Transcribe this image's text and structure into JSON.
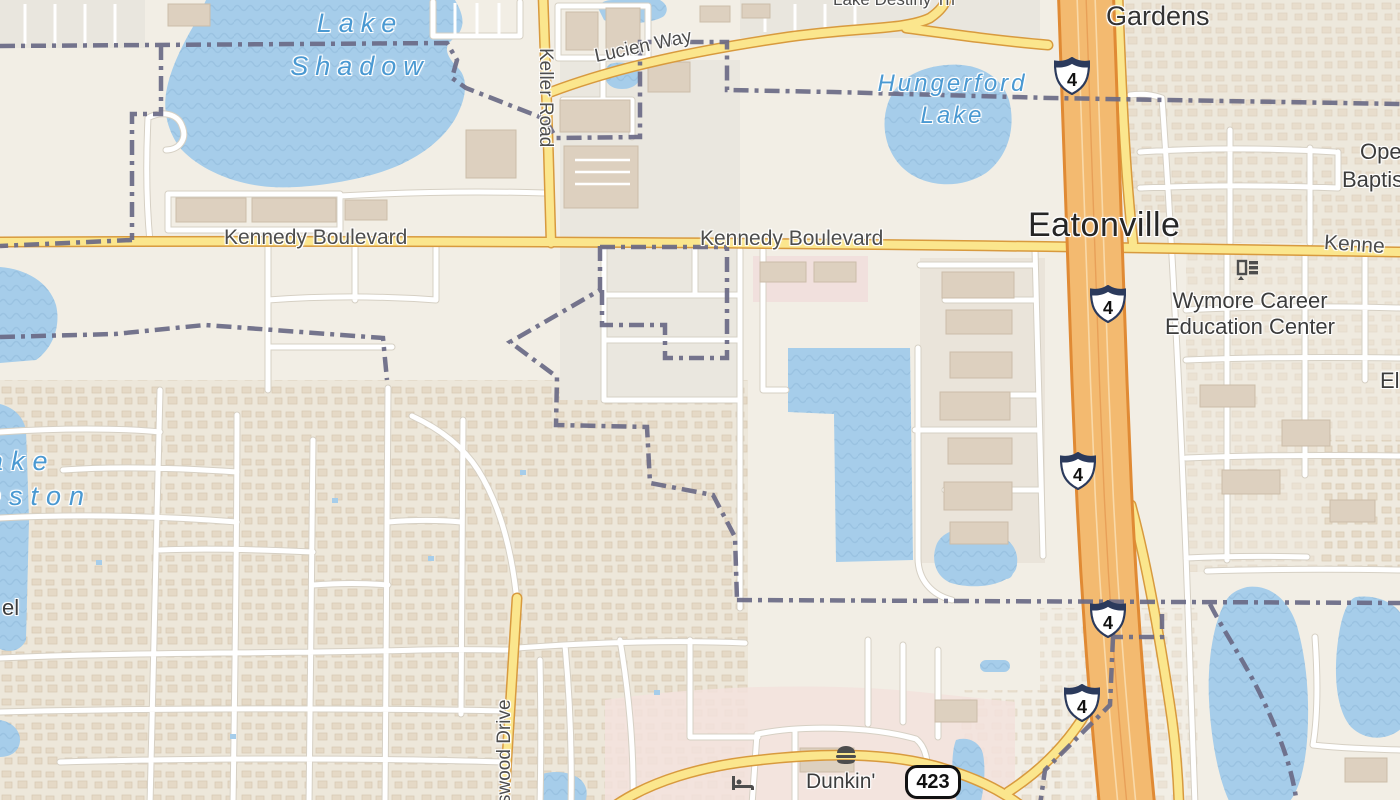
{
  "map": {
    "description": "Street map of Eatonville, Florida area with Interstate 4",
    "town_label": "Eatonville",
    "suburb_label": "Gardens",
    "water": {
      "lake_shadow_line1": "Lake",
      "lake_shadow_line2": "Shadow",
      "hungerford_line1": "Hungerford",
      "hungerford_line2": "Lake",
      "lake_weston_line1": "ake",
      "lake_weston_line2": "eston"
    },
    "roads": {
      "kennedy_west": "Kennedy Boulevard",
      "kennedy_center": "Kennedy Boulevard",
      "kennedy_east_partial": "Kenne",
      "keller": "Keller Road",
      "lucien": "Lucien Way",
      "swood_partial": "swood Drive",
      "lake_destiny_partial": "Lake Destiny Trl"
    },
    "pois": {
      "wymore_line1": "Wymore Career",
      "wymore_line2": "Education Center",
      "dunkin": "Dunkin'"
    },
    "edge_partials": {
      "ope": "Ope",
      "baptis": "Baptis",
      "el_right": "El",
      "el_left": "el"
    },
    "shields": {
      "interstate": "4",
      "state_route": "423"
    },
    "icons": {
      "fast_food": "burger-icon",
      "hotel": "bed-icon",
      "education": "school-icon"
    },
    "colors": {
      "land": "#f2eee5",
      "residential": "#ede7da",
      "water": "#a6cdea",
      "motorway": "#f3ba70",
      "secondary_road": "#fbe68d",
      "minor_road": "#ffffff",
      "boundary": "#6a6a86",
      "commercial": "#f3e2dd"
    }
  }
}
